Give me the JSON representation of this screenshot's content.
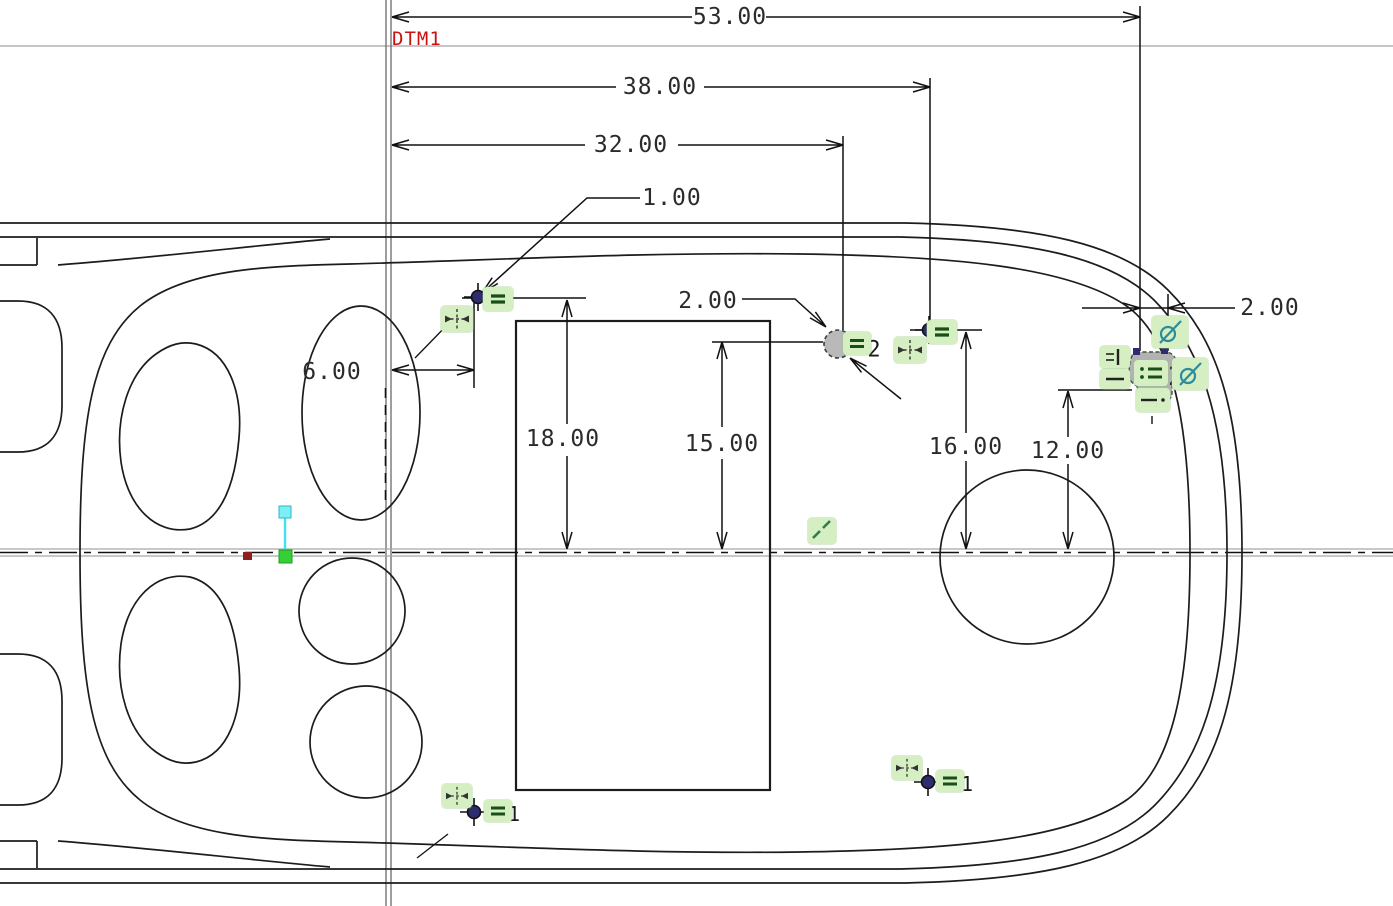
{
  "view": {
    "type": "cad-sketcher-drawing",
    "description": "Top view sketch of molded body with datum, dimensions and sketcher constraints"
  },
  "datum": {
    "label": "DTM1"
  },
  "dims": {
    "len53": "53.00",
    "len38": "38.00",
    "len32": "32.00",
    "off1": "1.00",
    "dia2": "2.00",
    "gap2": "2.00",
    "off6": "6.00",
    "h18": "18.00",
    "h15": "15.00",
    "h16": "16.00",
    "h12": "12.00"
  },
  "constraint_labels": {
    "equal_group_circle": "2",
    "equal_group_cluster": "2",
    "equal_group_bottom_left": "1",
    "equal_group_bottom_right": "1"
  },
  "icons": {
    "equal": "equal-constraint-icon",
    "align": "align-point-icon",
    "tangent": "tangent-constraint-icon",
    "vertical_bar": "vertical-constraint-icon",
    "horizontal_bar": "horizontal-constraint-icon",
    "colon_equal": "coincident-equal-icon",
    "parallel_diag": "parallel-constraint-icon",
    "dash_dot": "centerline-dash-icon"
  },
  "colors": {
    "badge_bg": "#d5efc3",
    "datum_label": "#cc1111",
    "point_fill": "#2c2c6e",
    "tangent": "#2e8b9a",
    "axis_cyan": "#3fe3ec",
    "origin_green": "#37cf37",
    "ref_red": "#8e2020",
    "geometry": "#1c1c1c",
    "gray_fill": "#b5b5b5"
  }
}
